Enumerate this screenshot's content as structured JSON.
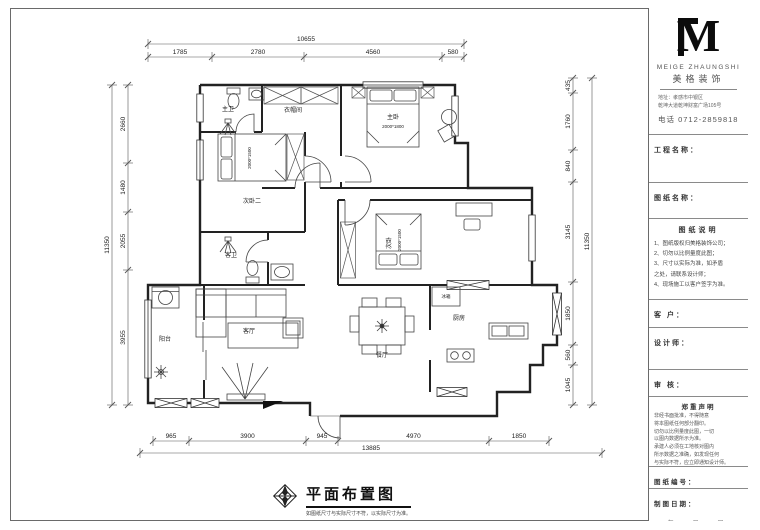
{
  "sheet_title": {
    "title": "平面布置图",
    "caption": "如图纸尺寸与实际尺寸不符，以实际尺寸为准。"
  },
  "title_block": {
    "logo": {
      "monogram": "M",
      "english": "MEIGE ZHAUNGSHI",
      "chinese": "美格装饰",
      "address_lines": [
        "地址：孝感市中银区",
        "乾坤大道乾坤财富广场105号"
      ],
      "phone": "电话   0712-2859818"
    },
    "project_label": "工程名称：",
    "drawing_label": "图纸名称：",
    "notes_title": "图纸说明",
    "notes": [
      "1、图纸版权归美格装饰公司；",
      "2、切勿以比例量度此图；",
      "3、尺寸以实际为准，如矛盾",
      "      之处，请联系设计师；",
      "4、现场施工以客户签字为准。"
    ],
    "client_label": "客  户：",
    "designer_label": "设计师：",
    "review_label": "审  核：",
    "statement_title": "郑重声明",
    "statement_lines": [
      "  非经书面批准，不得随意",
      "将本图纸任何部分翻印。",
      "  切勿以比例量度此图，一切",
      "以图内数据所示为准。",
      "  承建人必须在工地核对图内",
      "所示数据之准确，如发现任何",
      "与实际不符，应立即通知设计师。"
    ],
    "number_label": "图纸编号：",
    "number": "P-01",
    "date_label": "制图日期：",
    "date_placeholder": "年　月　日"
  },
  "plan": {
    "rooms": [
      {
        "label": "主卫",
        "x": 228,
        "y": 111,
        "fs": 6,
        "rot": 0
      },
      {
        "label": "衣帽间",
        "x": 293,
        "y": 112,
        "fs": 6,
        "rot": 0
      },
      {
        "label": "主卧",
        "x": 393,
        "y": 119,
        "fs": 6,
        "rot": 0
      },
      {
        "label": "2000*1800",
        "x": 393,
        "y": 128,
        "fs": 4.5,
        "rot": 0
      },
      {
        "label": "次卧二",
        "x": 252,
        "y": 203,
        "fs": 6,
        "rot": 0
      },
      {
        "label": "2000*1500",
        "x": 251,
        "y": 158,
        "fs": 4.5,
        "rot": -90
      },
      {
        "label": "客卫",
        "x": 231,
        "y": 257,
        "fs": 6,
        "rot": 0
      },
      {
        "label": "次卧",
        "x": 391,
        "y": 243,
        "fs": 6,
        "rot": -90
      },
      {
        "label": "2000*1500",
        "x": 401,
        "y": 240,
        "fs": 4.5,
        "rot": -90
      },
      {
        "label": "客厅",
        "x": 249,
        "y": 333,
        "fs": 6,
        "rot": 0
      },
      {
        "label": "餐厅",
        "x": 382,
        "y": 357,
        "fs": 6,
        "rot": 0
      },
      {
        "label": "厨房",
        "x": 459,
        "y": 320,
        "fs": 6,
        "rot": 0
      },
      {
        "label": "冰箱",
        "x": 446,
        "y": 298,
        "fs": 4.5,
        "rot": 0
      },
      {
        "label": "阳台",
        "x": 165,
        "y": 341,
        "fs": 6,
        "rot": 0
      }
    ],
    "dim_chains": [
      {
        "name": "top-segments",
        "axis": "h",
        "line": 57,
        "bounds": [
          148,
          212,
          304,
          442,
          464
        ],
        "labels": [
          "1785",
          "2780",
          "4560",
          "580"
        ]
      },
      {
        "name": "top-overall",
        "axis": "h",
        "line": 44,
        "bounds": [
          148,
          464
        ],
        "labels": [
          "10655"
        ]
      },
      {
        "name": "bottom-segments",
        "axis": "h",
        "line": 441,
        "bounds": [
          153,
          189,
          306,
          338,
          489,
          549
        ],
        "labels": [
          "965",
          "3900",
          "945",
          "4970",
          "1850"
        ]
      },
      {
        "name": "bottom-overall",
        "axis": "h",
        "line": 453,
        "bounds": [
          140,
          602
        ],
        "labels": [
          "13885"
        ]
      },
      {
        "name": "left-segments",
        "axis": "v",
        "line": 128,
        "bounds": [
          85,
          163,
          212,
          270,
          405
        ],
        "labels": [
          "2660",
          "1480",
          "2055",
          "3955"
        ]
      },
      {
        "name": "left-overall",
        "axis": "v",
        "line": 112,
        "bounds": [
          85,
          405
        ],
        "labels": [
          "11350"
        ]
      },
      {
        "name": "right-segments",
        "axis": "v",
        "line": 573,
        "bounds": [
          78,
          93,
          150,
          182,
          282,
          345,
          365,
          405
        ],
        "labels": [
          "435",
          "1760",
          "840",
          "3145",
          "1850",
          "560",
          "1045"
        ]
      },
      {
        "name": "right-overall",
        "axis": "v",
        "line": 592,
        "bounds": [
          78,
          405
        ],
        "labels": [
          "11350"
        ]
      }
    ],
    "colors": {
      "wall": "#222222",
      "thin": "#444444",
      "dim": "#555555",
      "text": "#222222"
    }
  }
}
